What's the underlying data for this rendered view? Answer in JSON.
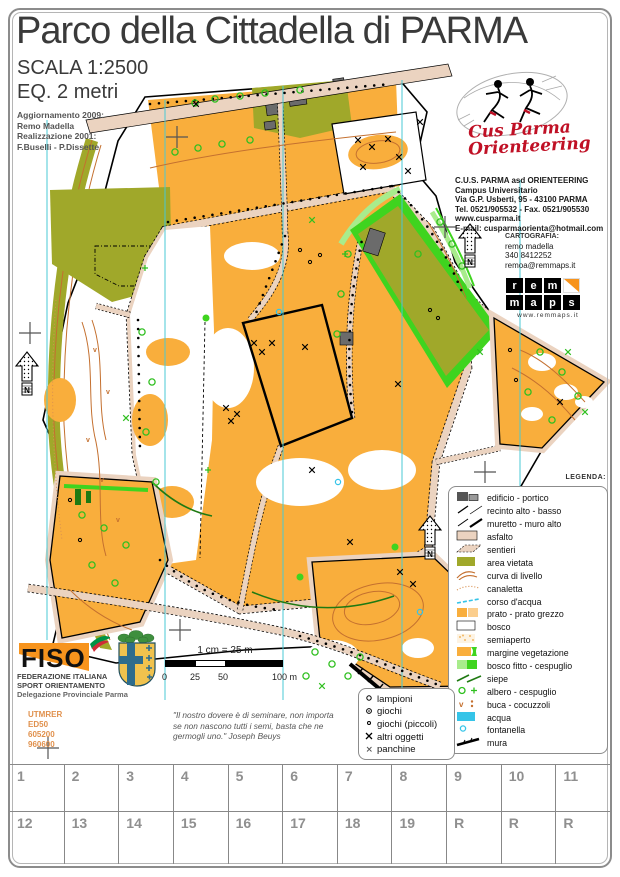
{
  "header": {
    "title": "Parco della Cittadella di PARMA",
    "scale": "SCALA 1:2500",
    "equidistance": "EQ. 2 metri",
    "credits": [
      "Aggiornamento 2009:",
      "Remo Madella",
      "Realizzazione 2001:",
      "F.Buselli - P.Dissette"
    ]
  },
  "club": {
    "name_line1": "Cus Parma",
    "name_line2": "Orienteering",
    "info": [
      "C.U.S. PARMA asd ORIENTEERING",
      "Campus Universitario",
      "Via G.P. Usberti, 95 - 43100 PARMA",
      "Tel. 0521/905532 - Fax. 0521/905530",
      "www.cusparma.it",
      "E-mail: cusparmaorienta@hotmail.com"
    ]
  },
  "cartography": {
    "heading": "CARTOGRAFIA:",
    "lines": [
      "remo madella",
      "340 8412252",
      "remoa@remmaps.it"
    ]
  },
  "remmaps": {
    "row1": [
      "r",
      "e",
      "m"
    ],
    "row2": [
      "m",
      "a",
      "p",
      "s"
    ],
    "site": "www.remmaps.it"
  },
  "legend": {
    "heading": "LEGENDA:",
    "items": [
      "edificio - portico",
      "recinto alto - basso",
      "muretto - muro alto",
      "asfalto",
      "sentieri",
      "area vietata",
      "curva di livello",
      "canaletta",
      "corso d'acqua",
      "prato - prato grezzo",
      "bosco",
      "semiaperto",
      "margine vegetazione",
      "bosco fitto - cespuglio",
      "siepe",
      "albero - cespuglio",
      "buca - cocuzzoli",
      "acqua",
      "fontanella",
      "mura"
    ]
  },
  "mini_legend": {
    "items": [
      "lampioni",
      "giochi",
      "giochi (piccoli)",
      "altri oggetti",
      "panchine"
    ]
  },
  "fiso": {
    "logo_text": "FISO",
    "lines": [
      "FEDERAZIONE ITALIANA",
      "SPORT ORIENTAMENTO",
      "Delegazione Provinciale Parma"
    ]
  },
  "scalebar": {
    "caption": "1 cm = 25 m",
    "ticks": [
      "0",
      "25",
      "50",
      "100 m"
    ]
  },
  "georef": {
    "lines": [
      "UTMRER",
      "ED50",
      "605200",
      "960600"
    ]
  },
  "quote": {
    "text": "\"Il nostro dovere è di seminare, non importa se non nascono tutti i semi, basta che ne germogli uno.\"  Joseph Beuys"
  },
  "footer_grid": {
    "cells": [
      "1",
      "2",
      "3",
      "4",
      "5",
      "6",
      "7",
      "8",
      "9",
      "10",
      "11",
      "12",
      "13",
      "14",
      "15",
      "16",
      "17",
      "18",
      "19",
      "R",
      "R",
      "R"
    ]
  },
  "colors": {
    "prato": "#f9ae3c",
    "prato_grezzo": "#fbce8d",
    "asfalto": "#ebd3c0",
    "area_vietata": "#a0a82a",
    "bosco_fitto": "#3fd41f",
    "bosco_fitto_chiaro": "#a8ec8c",
    "acqua": "#35c4e8",
    "curva_livello": "#c4702f",
    "meridiano": "#49c9d4",
    "club_red": "#c01025",
    "fiso_orange": "#f7941d",
    "edificio": "#6b6b6b"
  }
}
